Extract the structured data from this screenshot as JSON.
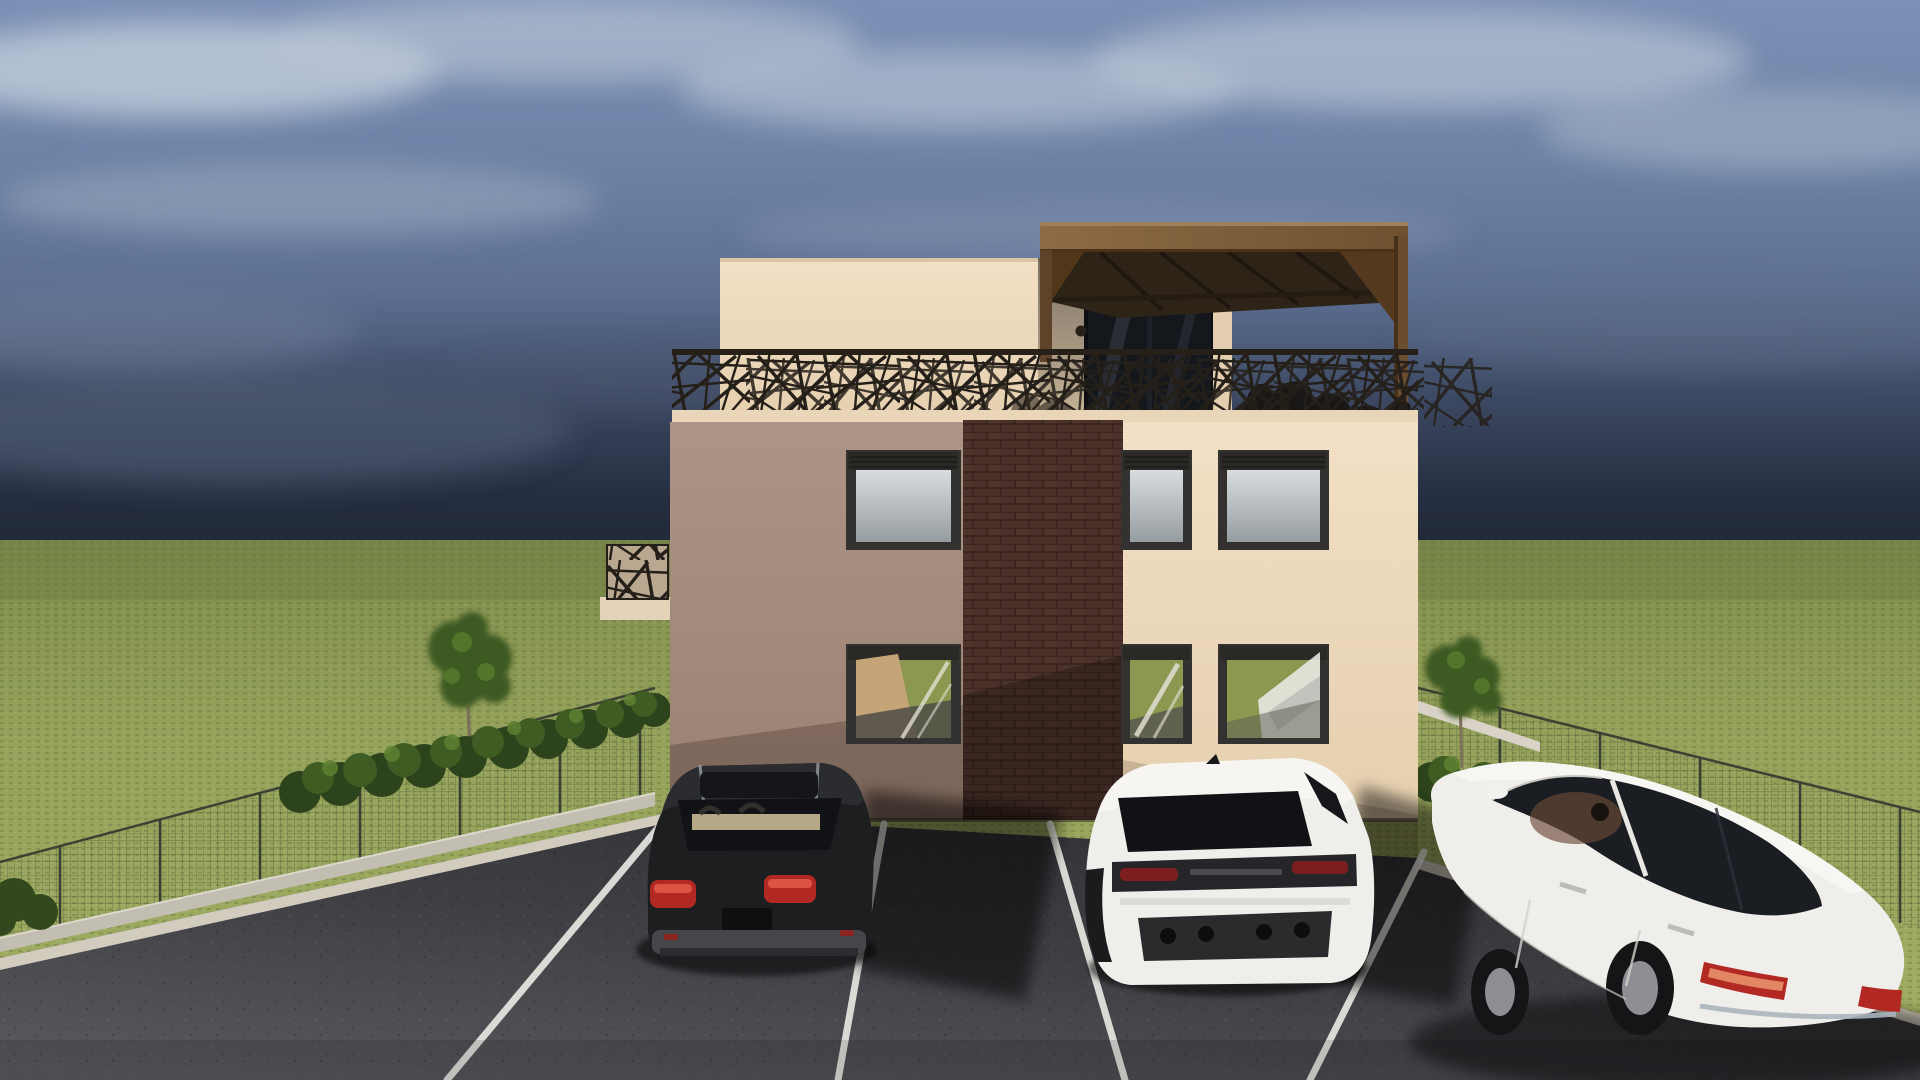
{
  "scene": {
    "kind": "architectural 3D exterior rendering",
    "description": "Two-storey residential building at dusk with rooftop terrace, decorative laser-cut railing, wooden pergola, hedges, wire fence, lawn and a front parking lot with three parked cars",
    "time_of_day": "dusk"
  },
  "colors": {
    "sky_top": "#7b90b5",
    "sky_mid": "#687da0",
    "sky_dark": "#2c3547",
    "sky_horizon": "#1f2735",
    "grass": "#94a15a",
    "grass_dark": "#7e8c4c",
    "asphalt": "#3c3c40",
    "asphalt_light": "#56565c",
    "facade_shadow_wall": "#a78c7d",
    "facade_cream_wall": "#efdcc1",
    "penthouse_wall": "#eedfc8",
    "parapet_band": "#e9d6b9",
    "brick": "#4c312a",
    "brick_mortar": "#35211b",
    "pergola_wood": "#82613c",
    "pergola_soffit": "#2e2317",
    "railing_metal": "#241f19",
    "window_frame": "#343230",
    "glass_sky": "#c9ced1",
    "glass_green": "#8c984f",
    "curb": "#d2ccbf",
    "parking_line": "#eceae4",
    "hedge_green": "#3f5d23",
    "tree_green": "#3e5a24",
    "car_black": "#1c1e20",
    "car_white": "#efeeea",
    "taillight_red": "#b22822"
  },
  "building": {
    "storeys_visible": 2,
    "rooftop": [
      "penthouse volume",
      "wooden pergola canopy",
      "decorative crisscross metal railing",
      "outdoor furniture silhouettes",
      "glass sliding door",
      "2 wall lamps"
    ],
    "facade_sections": [
      "shadowed taupe render (left)",
      "dark brown brick column (center)",
      "lit cream render (right)"
    ],
    "windows_upper_floor": 3,
    "windows_ground_floor": 3,
    "window_features": [
      "dark frames",
      "roller-shutter boxes",
      "sky and grass reflections"
    ]
  },
  "vehicles": [
    {
      "name": "black SUV",
      "color": "black",
      "view": "rear",
      "bay": "left parking bay"
    },
    {
      "name": "white sport SUV",
      "color": "white",
      "view": "rear three-quarter",
      "bay": "center parking bay"
    },
    {
      "name": "white luxury sedan",
      "color": "white",
      "view": "side three-quarter from above",
      "bay": "right parking bay"
    }
  ],
  "environment": {
    "parking_lines": 4,
    "curbs": 2,
    "hedgerows": 2,
    "trees": 2,
    "fences": [
      "wire mesh fence left",
      "wire mesh fence right"
    ],
    "lawn": "large green field to the horizon"
  }
}
